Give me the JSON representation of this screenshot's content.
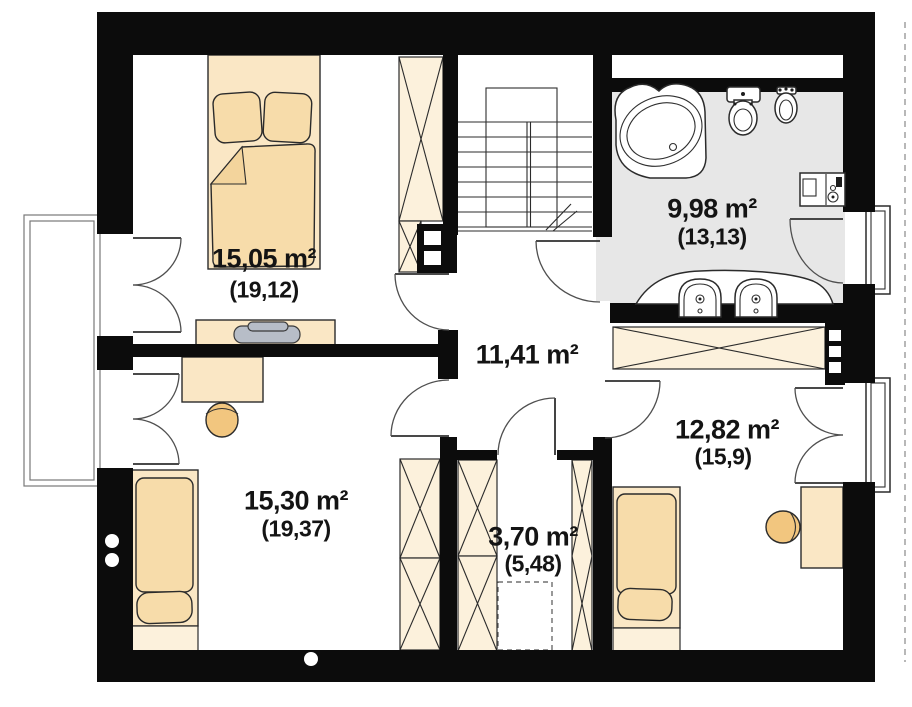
{
  "plan": {
    "rooms": [
      {
        "id": "bedroom-1",
        "area": "15,05 m²",
        "gross": "(19,12)"
      },
      {
        "id": "bathroom",
        "area": "9,98 m²",
        "gross": "(13,13)"
      },
      {
        "id": "hallway",
        "area": "11,41 m²",
        "gross": ""
      },
      {
        "id": "bedroom-2",
        "area": "15,30 m²",
        "gross": "(19,37)"
      },
      {
        "id": "closet",
        "area": "3,70 m²",
        "gross": "(5,48)"
      },
      {
        "id": "bedroom-3",
        "area": "12,82 m²",
        "gross": "(15,9)"
      }
    ]
  },
  "colors": {
    "wall": "#0c0c0c",
    "outline": "#2b2b2b",
    "furniture_fill": "#fae7c5",
    "furniture_light": "#fcf1dc",
    "bedding_fill": "#f7dcaa",
    "bedding_fold": "#f3d49c",
    "stool_fill": "#f2c67f",
    "bath_floor": "#e7e7e7",
    "laptop": "#b7bdc7",
    "label": "#141414"
  }
}
